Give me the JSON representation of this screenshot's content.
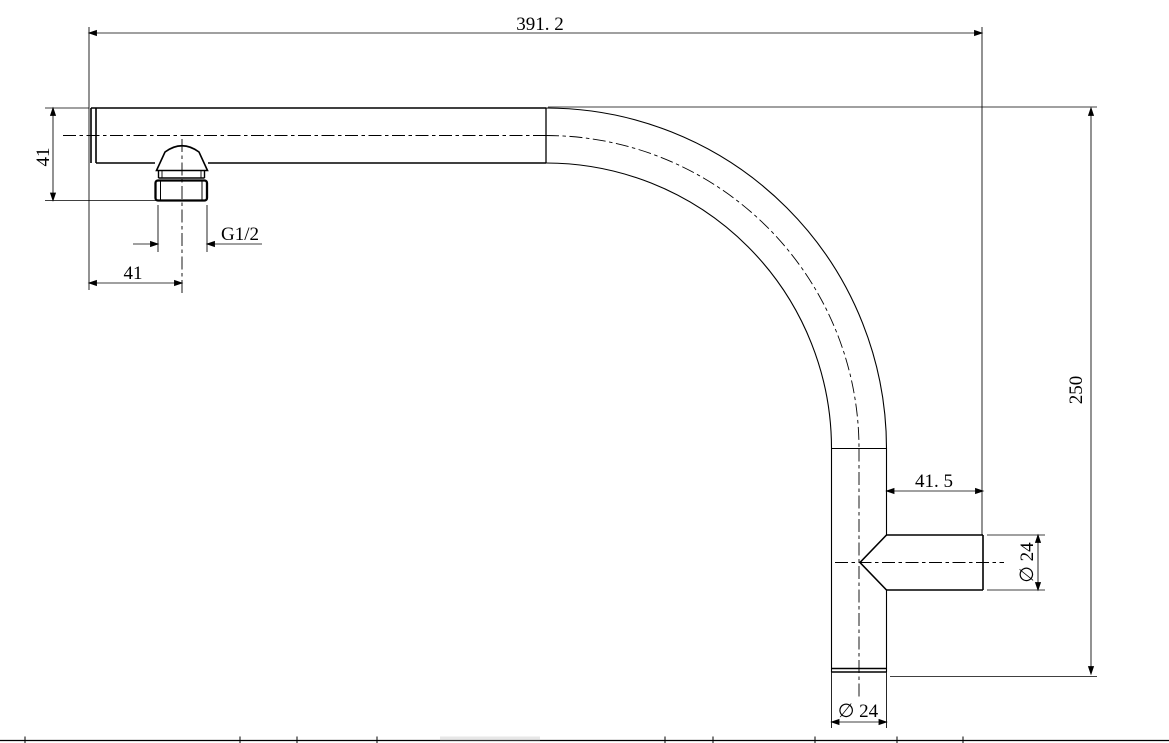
{
  "drawing": {
    "title": "shower-arm-elbow-technical-drawing",
    "dimensions": {
      "overall_length": "391. 2",
      "inlet_height": "41",
      "thread_size": "G1/2",
      "inlet_offset": "41",
      "outlet_length": "41. 5",
      "outlet_diameter": "∅ 24",
      "overall_height": "250",
      "pipe_diameter": "∅ 24"
    },
    "colors": {
      "line": "#000000",
      "background": "#ffffff"
    }
  }
}
